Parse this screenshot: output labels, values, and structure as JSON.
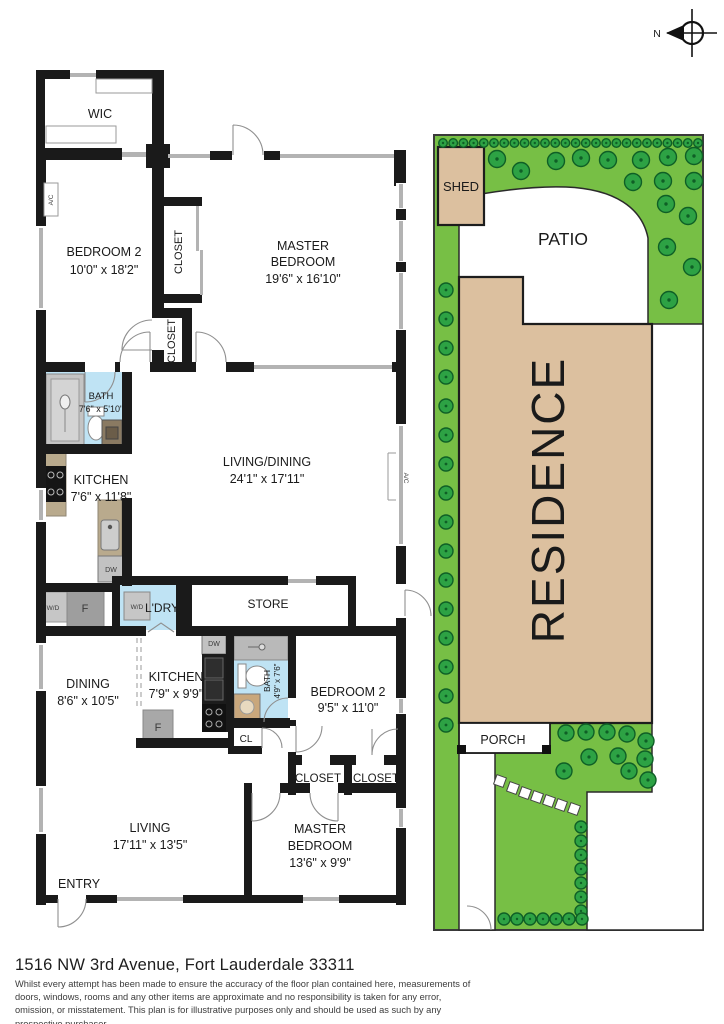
{
  "compass": {
    "north_label": "N"
  },
  "floor_plan": {
    "wall_color": "#1a1a1a",
    "window_color": "#b3b3b3",
    "bath_floor_color": "#bfe3f4",
    "counter_color": "#b9aa8d",
    "rooms": {
      "wic": {
        "name": "WIC"
      },
      "bedroom2_top": {
        "name": "BEDROOM 2",
        "dims": "10'0\" x 18'2\""
      },
      "closet_top1": {
        "name": "CLOSET"
      },
      "closet_top2": {
        "name": "CLOSET"
      },
      "master_top": {
        "name_line1": "MASTER",
        "name_line2": "BEDROOM",
        "dims": "19'6\" x 16'10\""
      },
      "bath_top": {
        "name": "BATH",
        "dims": "7'6\" x 5'10\""
      },
      "kitchen_top": {
        "name": "KITCHEN",
        "dims": "7'6\" x 11'8\""
      },
      "living_dining": {
        "name": "LIVING/DINING",
        "dims": "24'1\" x 17'11\""
      },
      "ldry": {
        "name": "L'DRY"
      },
      "store": {
        "name": "STORE"
      },
      "dining": {
        "name": "DINING",
        "dims": "8'6\" x 10'5\""
      },
      "kitchen_bottom": {
        "name": "KITCHEN",
        "dims": "7'9\" x 9'9\""
      },
      "bath_bottom": {
        "name": "BATH",
        "dims": "4'9\" x 7'6\""
      },
      "bedroom2_bottom": {
        "name": "BEDROOM 2",
        "dims": "9'5\" x 11'0\""
      },
      "cl": {
        "name": "CL"
      },
      "closet_bottom1": {
        "name": "CLOSET"
      },
      "closet_bottom2": {
        "name": "CLOSET"
      },
      "living": {
        "name": "LIVING",
        "dims": "17'11\" x 13'5\""
      },
      "master_bottom": {
        "name_line1": "MASTER",
        "name_line2": "BEDROOM",
        "dims": "13'6\" x 9'9\""
      },
      "entry": {
        "name": "ENTRY"
      }
    },
    "appliances": {
      "ac_left": "A/C",
      "ac_right": "A/C",
      "wd_left": "W/D",
      "wd_laundry": "W/D",
      "f_top": "F",
      "f_bottom": "F",
      "dw_top": "DW",
      "dw_bottom": "DW"
    }
  },
  "site_plan": {
    "labels": {
      "shed": "SHED",
      "patio": "PATIO",
      "residence": "RESIDENCE",
      "porch": "PORCH"
    },
    "colors": {
      "lawn": "#77bf45",
      "shrub": "#2da244",
      "shrub_outline": "#0f5f26",
      "building": "#dcc09f"
    }
  },
  "footer": {
    "address": "1516 NW 3rd Avenue, Fort Lauderdale 33311",
    "disclaimer": "Whilst every attempt has been made to ensure the accuracy of the floor plan contained here, measurements of doors, windows, rooms and any other items are approximate and no responsibility is taken for any error, omission, or misstatement. This plan is for illustrative purposes only and should be used as such by any prospective purchaser."
  }
}
